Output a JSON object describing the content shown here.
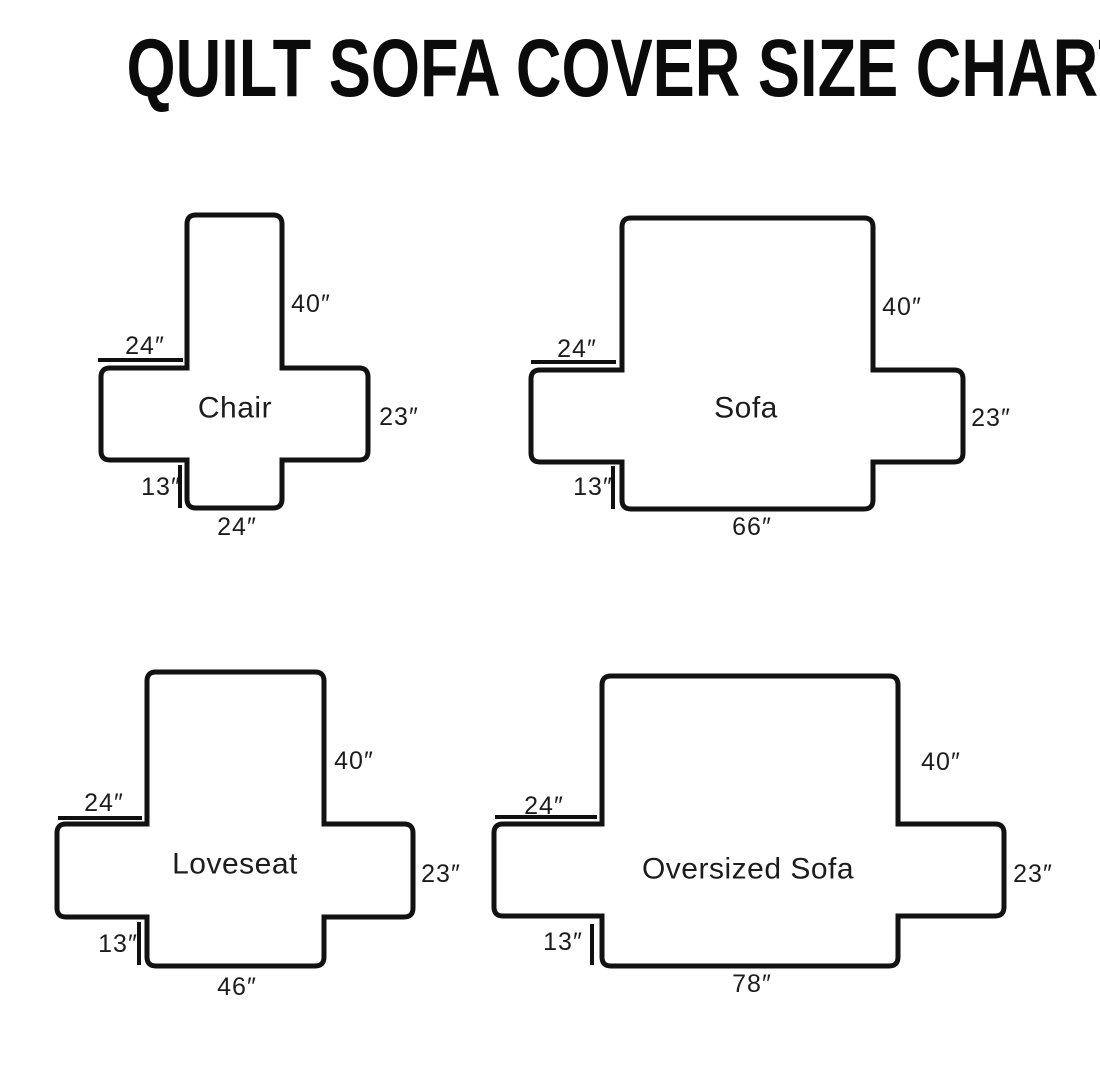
{
  "title": "QUILT SOFA COVER SIZE CHART",
  "colors": {
    "background": "#ffffff",
    "line": "#121212",
    "text": "#1c1c1c"
  },
  "diagrams": [
    {
      "name": "Chair",
      "back_height": "40″",
      "arm_top_width": "24″",
      "seat_depth": "23″",
      "front_skirt_height": "13″",
      "base_width": "24″"
    },
    {
      "name": "Sofa",
      "back_height": "40″",
      "arm_top_width": "24″",
      "seat_depth": "23″",
      "front_skirt_height": "13″",
      "base_width": "66″"
    },
    {
      "name": "Loveseat",
      "back_height": "40″",
      "arm_top_width": "24″",
      "seat_depth": "23″",
      "front_skirt_height": "13″",
      "base_width": "46″"
    },
    {
      "name": "Oversized Sofa",
      "back_height": "40″",
      "arm_top_width": "24″",
      "seat_depth": "23″",
      "front_skirt_height": "13″",
      "base_width": "78″"
    }
  ]
}
